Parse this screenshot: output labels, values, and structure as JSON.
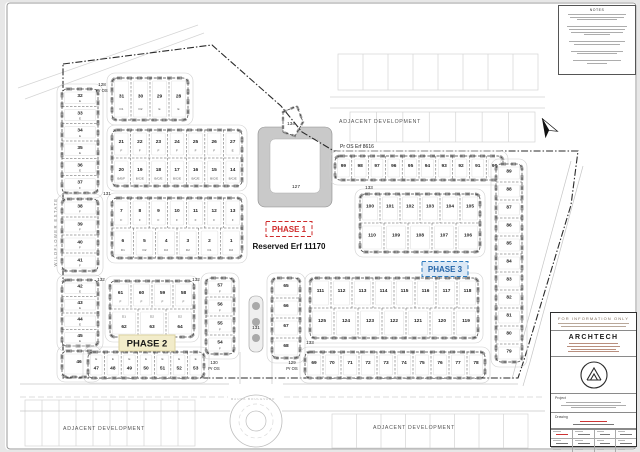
{
  "notes_panel": {
    "title": "NOTES"
  },
  "title_panel": {
    "banner": "FOR INFORMATION ONLY",
    "firm": "ARCHTECH",
    "project_label": "Project",
    "drawing_label": "Drawing"
  },
  "plan": {
    "estate_label": "WILDFLOWER ESTATE",
    "boulevard_label": "MAUKA BOULEVARD",
    "reserved_label": "Reserved Erf 11170",
    "open_space_label": "Pr OS Erf 8616",
    "phases": [
      {
        "t": "PHASE 1",
        "x": 289,
        "y": 229,
        "w": 46,
        "h": 15,
        "fill": "#ffffff",
        "stroke": "#cf2b2b",
        "color": "#cf2b2b",
        "dash": "4 2.2",
        "s": 8
      },
      {
        "t": "PHASE 2",
        "x": 147,
        "y": 343,
        "w": 56,
        "h": 16,
        "fill": "#f2ecca",
        "stroke": "#ddd3a2",
        "color": "#1a1a1a",
        "dash": "",
        "s": 9.5
      },
      {
        "t": "PHASE 3",
        "x": 445,
        "y": 269,
        "w": 46,
        "h": 15,
        "fill": "#dce9f6",
        "stroke": "#2e7bbe",
        "color": "#2565a8",
        "dash": "4 2.2",
        "s": 8
      }
    ],
    "labels": [
      {
        "t": "128",
        "x": 102,
        "y": 86,
        "s": 4.6
      },
      {
        "t": "Pr OS",
        "x": 102,
        "y": 92,
        "s": 4.2
      },
      {
        "t": "131",
        "x": 107,
        "y": 195,
        "s": 4.6
      },
      {
        "t": "132",
        "x": 101,
        "y": 281,
        "s": 4.6
      },
      {
        "t": "132",
        "x": 196,
        "y": 281,
        "s": 4.6
      },
      {
        "t": "134",
        "x": 291,
        "y": 125,
        "s": 4.6
      },
      {
        "t": "127",
        "x": 296,
        "y": 188,
        "s": 4.8
      },
      {
        "t": "133",
        "x": 369,
        "y": 189,
        "s": 4.6
      },
      {
        "t": "133",
        "x": 310,
        "y": 344,
        "s": 4.6
      },
      {
        "t": "131",
        "x": 256,
        "y": 329,
        "s": 4.6
      },
      {
        "t": "130",
        "x": 214,
        "y": 364,
        "s": 4.4
      },
      {
        "t": "Pr OS",
        "x": 214,
        "y": 370,
        "s": 4.2
      },
      {
        "t": "129",
        "x": 292,
        "y": 364,
        "s": 4.4
      },
      {
        "t": "Pr OS",
        "x": 292,
        "y": 370,
        "s": 4.2
      },
      {
        "t": "Pr OS Erf 8616",
        "x": 340,
        "y": 148,
        "s": 5,
        "anchor": "start"
      },
      {
        "t": "ADJACENT DEVELOPMENT",
        "x": 380,
        "y": 123,
        "s": 5.2,
        "fill": "#555",
        "sp": 0.7
      },
      {
        "t": "ADJACENT DEVELOPMENT",
        "x": 104,
        "y": 430,
        "s": 5.2,
        "fill": "#555",
        "sp": 0.7
      },
      {
        "t": "ADJACENT DEVELOPMENT",
        "x": 414,
        "y": 429,
        "s": 5.2,
        "fill": "#555",
        "sp": 0.7
      },
      {
        "t": "MAUKA BOULEVARD",
        "x": 253,
        "y": 400,
        "s": 3,
        "fill": "#b5b5b5",
        "sp": 1
      },
      {
        "t": "WILDFLOWER ESTATE",
        "x": 57,
        "y": 232,
        "s": 4.2,
        "fill": "#808080",
        "sp": 1.4,
        "rot": -90
      },
      {
        "t": "Reserved Erf 11170",
        "x": 289,
        "y": 249,
        "s": 8,
        "fill": "#111",
        "weight": "bold"
      }
    ],
    "blocks": [
      {
        "x": 112,
        "y": 78,
        "w": 76,
        "h": 42,
        "rows": [
          {
            "cells": [
              {
                "n": "31",
                "t": "D1"
              },
              {
                "n": "30",
                "t": "D2"
              },
              {
                "n": "29",
                "t": "E"
              },
              {
                "n": "28",
                "t": "E"
              }
            ]
          }
        ]
      },
      {
        "x": 62,
        "y": 89,
        "w": 36,
        "h": 104,
        "rows": [
          {
            "cells": [
              {
                "n": "32",
                "t": "E"
              }
            ]
          },
          {
            "cells": [
              {
                "n": "33",
                "t": "E"
              }
            ]
          },
          {
            "cells": [
              {
                "n": "34",
                "t": "E"
              }
            ]
          },
          {
            "cells": [
              {
                "n": "35",
                "t": "E"
              }
            ]
          },
          {
            "cells": [
              {
                "n": "36",
                "t": "E"
              }
            ]
          },
          {
            "cells": [
              {
                "n": "37",
                "t": "F"
              }
            ]
          }
        ]
      },
      {
        "x": 62,
        "y": 199,
        "w": 36,
        "h": 72,
        "rows": [
          {
            "cells": [
              {
                "n": "38",
                "t": "F"
              }
            ]
          },
          {
            "cells": [
              {
                "n": "39",
                "t": "F"
              }
            ]
          },
          {
            "cells": [
              {
                "n": "40",
                "t": "F"
              }
            ]
          },
          {
            "cells": [
              {
                "n": "41",
                "t": "F"
              }
            ]
          }
        ]
      },
      {
        "x": 62,
        "y": 280,
        "w": 36,
        "h": 66,
        "rows": [
          {
            "cells": [
              {
                "n": "42",
                "t": "E"
              }
            ]
          },
          {
            "cells": [
              {
                "n": "43",
                "t": "E"
              }
            ]
          },
          {
            "cells": [
              {
                "n": "44",
                "t": "E"
              }
            ]
          },
          {
            "cells": [
              {
                "n": "45",
                "t": "E"
              }
            ]
          }
        ]
      },
      {
        "x": 62,
        "y": 351,
        "w": 34,
        "h": 26,
        "rows": [
          {
            "cells": [
              {
                "n": "46"
              }
            ]
          }
        ]
      },
      {
        "x": 112,
        "y": 130,
        "w": 130,
        "h": 56,
        "rows": [
          {
            "cells": [
              {
                "n": "21",
                "t": "F"
              },
              {
                "n": "22",
                "t": "F"
              },
              {
                "n": "23",
                "t": "F"
              },
              {
                "n": "24",
                "t": "F"
              },
              {
                "n": "25",
                "t": "F"
              },
              {
                "n": "26",
                "t": "F"
              },
              {
                "n": "27",
                "t": "E"
              }
            ]
          },
          {
            "cells": [
              {
                "n": "20",
                "t": "B/E/F"
              },
              {
                "n": "19",
                "t": "B/C/E"
              },
              {
                "n": "18",
                "t": "B/C/E"
              },
              {
                "n": "17",
                "t": "B/C/E"
              },
              {
                "n": "16",
                "t": "B/C/E"
              },
              {
                "n": "15",
                "t": "B/C/E"
              },
              {
                "n": "14",
                "t": "B/C/E"
              }
            ]
          }
        ]
      },
      {
        "x": 112,
        "y": 198,
        "w": 130,
        "h": 60,
        "rows": [
          {
            "cells": [
              {
                "n": "7",
                "t": "F"
              },
              {
                "n": "8",
                "t": "F"
              },
              {
                "n": "9",
                "t": "F"
              },
              {
                "n": "10",
                "t": "F"
              },
              {
                "n": "11",
                "t": "F"
              },
              {
                "n": "12",
                "t": "F"
              },
              {
                "n": "13",
                "t": "F"
              }
            ]
          },
          {
            "cells": [
              {
                "n": "6",
                "t": "D1"
              },
              {
                "n": "5",
                "t": "D2"
              },
              {
                "n": "4",
                "t": "D2"
              },
              {
                "n": "3",
                "t": "D2"
              },
              {
                "n": "2",
                "t": "D1"
              },
              {
                "n": "1",
                "t": "D2"
              }
            ]
          }
        ]
      },
      {
        "x": 110,
        "y": 281,
        "w": 84,
        "h": 56,
        "rows": [
          {
            "cells": [
              {
                "n": "61",
                "t": "F"
              },
              {
                "n": "60",
                "t": "F"
              },
              {
                "n": "59",
                "t": "F"
              },
              {
                "n": "58",
                "t": "F"
              }
            ]
          },
          {
            "tpos": "top",
            "cells": [
              {
                "n": "62",
                "t": "D1"
              },
              {
                "n": "63",
                "t": "D2"
              },
              {
                "n": "64",
                "t": "D2"
              }
            ]
          }
        ]
      },
      {
        "x": 88,
        "y": 352,
        "w": 116,
        "h": 26,
        "rows": [
          {
            "tpos": "top",
            "cells": [
              {
                "n": "47",
                "t": "E"
              },
              {
                "n": "48",
                "t": "E"
              },
              {
                "n": "49",
                "t": "E"
              },
              {
                "n": "50",
                "t": "E"
              },
              {
                "n": "51",
                "t": "E"
              },
              {
                "n": "52",
                "t": "E"
              },
              {
                "n": "53",
                "t": "E"
              }
            ]
          }
        ]
      },
      {
        "x": 206,
        "y": 278,
        "w": 28,
        "h": 76,
        "rows": [
          {
            "cells": [
              {
                "n": "57",
                "t": "F"
              }
            ]
          },
          {
            "cells": [
              {
                "n": "56",
                "t": "F"
              }
            ]
          },
          {
            "cells": [
              {
                "n": "55",
                "t": "F"
              }
            ]
          },
          {
            "cells": [
              {
                "n": "54",
                "t": "F"
              }
            ]
          }
        ]
      },
      {
        "x": 272,
        "y": 278,
        "w": 28,
        "h": 80,
        "rows": [
          {
            "cells": [
              {
                "n": "65"
              }
            ]
          },
          {
            "cells": [
              {
                "n": "66"
              }
            ]
          },
          {
            "cells": [
              {
                "n": "67"
              }
            ]
          },
          {
            "cells": [
              {
                "n": "68"
              }
            ]
          }
        ]
      },
      {
        "x": 335,
        "y": 156,
        "w": 168,
        "h": 24,
        "rows": [
          {
            "cells": [
              {
                "n": "99"
              },
              {
                "n": "98"
              },
              {
                "n": "97"
              },
              {
                "n": "96"
              },
              {
                "n": "95"
              },
              {
                "n": "94"
              },
              {
                "n": "93"
              },
              {
                "n": "92"
              },
              {
                "n": "91"
              },
              {
                "n": "90"
              }
            ]
          }
        ]
      },
      {
        "x": 360,
        "y": 194,
        "w": 120,
        "h": 58,
        "rows": [
          {
            "cells": [
              {
                "n": "100"
              },
              {
                "n": "101"
              },
              {
                "n": "102"
              },
              {
                "n": "103"
              },
              {
                "n": "104"
              },
              {
                "n": "105"
              }
            ]
          },
          {
            "cells": [
              {
                "n": "110"
              },
              {
                "n": "109"
              },
              {
                "n": "108"
              },
              {
                "n": "107"
              },
              {
                "n": "106"
              }
            ]
          }
        ]
      },
      {
        "x": 496,
        "y": 164,
        "w": 26,
        "h": 198,
        "rows": [
          {
            "cells": [
              {
                "n": "89"
              }
            ]
          },
          {
            "cells": [
              {
                "n": "88"
              }
            ]
          },
          {
            "cells": [
              {
                "n": "87"
              }
            ]
          },
          {
            "cells": [
              {
                "n": "86"
              }
            ]
          },
          {
            "cells": [
              {
                "n": "85"
              }
            ]
          },
          {
            "cells": [
              {
                "n": "84"
              }
            ]
          },
          {
            "cells": [
              {
                "n": "83"
              }
            ]
          },
          {
            "cells": [
              {
                "n": "82"
              }
            ]
          },
          {
            "cells": [
              {
                "n": "81"
              }
            ]
          },
          {
            "cells": [
              {
                "n": "80"
              }
            ]
          },
          {
            "cells": [
              {
                "n": "79"
              }
            ]
          }
        ]
      },
      {
        "x": 310,
        "y": 278,
        "w": 168,
        "h": 60,
        "rows": [
          {
            "cells": [
              {
                "n": "111"
              },
              {
                "n": "112"
              },
              {
                "n": "113"
              },
              {
                "n": "114"
              },
              {
                "n": "115"
              },
              {
                "n": "116"
              },
              {
                "n": "117"
              },
              {
                "n": "118"
              }
            ]
          },
          {
            "cells": [
              {
                "n": "125"
              },
              {
                "n": "124"
              },
              {
                "n": "123"
              },
              {
                "n": "122"
              },
              {
                "n": "121"
              },
              {
                "n": "120"
              },
              {
                "n": "119"
              }
            ]
          }
        ]
      },
      {
        "x": 305,
        "y": 352,
        "w": 180,
        "h": 26,
        "rows": [
          {
            "cells": [
              {
                "n": "69"
              },
              {
                "n": "70"
              },
              {
                "n": "71"
              },
              {
                "n": "72"
              },
              {
                "n": "73"
              },
              {
                "n": "74"
              },
              {
                "n": "75"
              },
              {
                "n": "76"
              },
              {
                "n": "77"
              },
              {
                "n": "78"
              }
            ]
          }
        ]
      }
    ]
  }
}
